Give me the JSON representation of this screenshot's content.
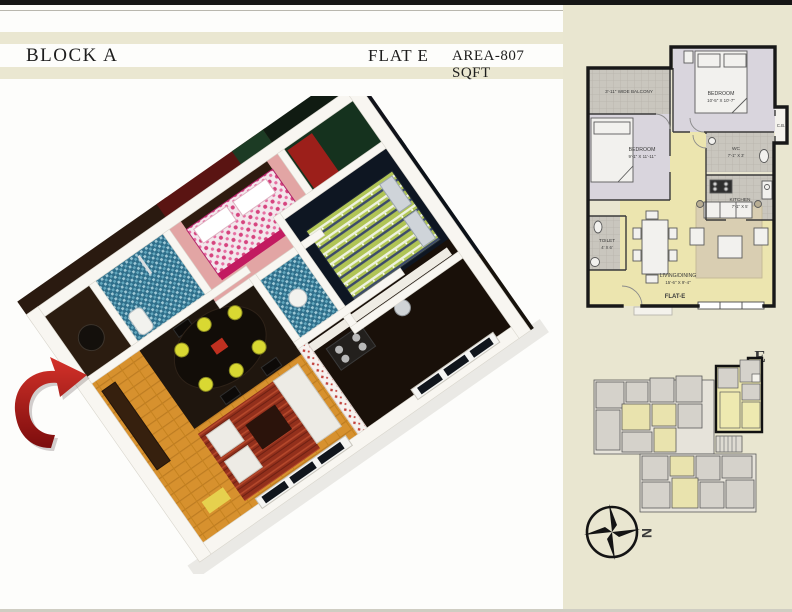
{
  "header": {
    "block": "BLOCK A",
    "flat": "FLAT E",
    "area": "AREA-807 SQFT"
  },
  "plan2d": {
    "balcony": {
      "name": "3'-11\" WIDE BALCONY"
    },
    "bedroom_top": {
      "name": "BEDROOM",
      "dims": "10'-5\" X 10'-7\""
    },
    "bedroom_left": {
      "name": "BEDROOM",
      "dims": "9'-1\" X 11'-11\""
    },
    "cupboard": {
      "name": "C.B."
    },
    "wc": {
      "name": "WC",
      "dims": "7'-1\" X 3'"
    },
    "kitchen": {
      "name": "KITCHEN",
      "dims": "7'-1\" X 5'"
    },
    "toilet": {
      "name": "TOILET",
      "dims": "4' X 6'"
    },
    "living": {
      "name": "LIVING/DINING",
      "dims": "15'-6\" X 9'-4\""
    },
    "flat_tag": "FLAT-E"
  },
  "key_plan": {
    "flat_label": "E"
  },
  "compass": {
    "north_label": "N"
  },
  "colors": {
    "paper_cream": "#e9e6d0",
    "sheet_white": "#fdfdfb",
    "ink": "#1d1d1d",
    "stripe_cream": "#eae7d1",
    "arrow_red": "#b3231e",
    "flat_label_red": "#c0392b",
    "plan_living_yellow": "#ece5af",
    "plan_room_lavender": "#d9d5dd",
    "plan_tile_grey": "#c9c6be",
    "wall_black": "#181818"
  }
}
